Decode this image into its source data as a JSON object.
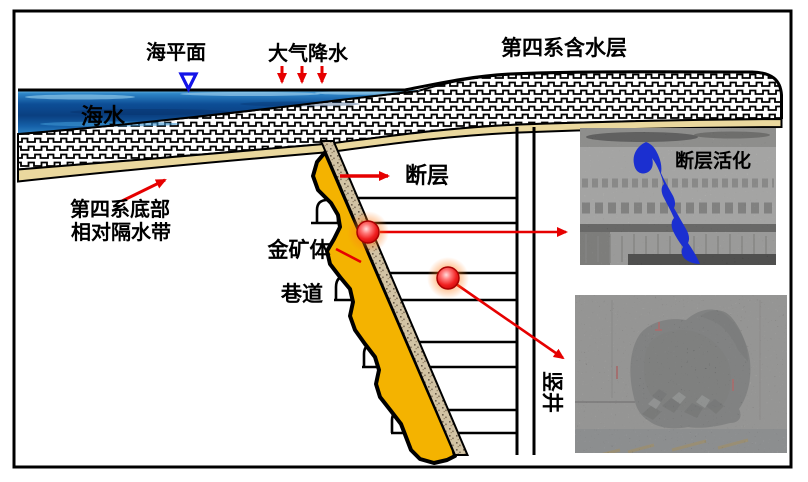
{
  "figure": {
    "type": "geological-cross-section-diagram",
    "labels": {
      "sea_level": "海平面",
      "precipitation": "大气降水",
      "quaternary_aquifer": "第四系含水层",
      "seawater": "海水",
      "fault": "断层",
      "aquitard_line1": "第四系底部",
      "aquitard_line2": "相对隔水带",
      "gold_ore_body": "金矿体",
      "tunnel": "巷道",
      "shaft": "竖井",
      "fault_activation": "断层活化"
    },
    "colors": {
      "hazard_red": "#e60000",
      "arrow_red": "#e60000",
      "water_marker_blue": "#1313e8",
      "fault_activation_blue": "#2329c8",
      "fault_blob_blue": "#1b2fd0",
      "gold": "#f4b300",
      "sand": "#ead89e",
      "sea_deep": "#0a3f80",
      "sea_light": "#7cc4ea"
    },
    "icons": {
      "water_level_marker": "open-triangle-down",
      "rain_arrows": "three-red-down-arrows",
      "hazard_point": "glowing-red-circle"
    },
    "hazard_points": 2,
    "mine_levels": 4
  }
}
